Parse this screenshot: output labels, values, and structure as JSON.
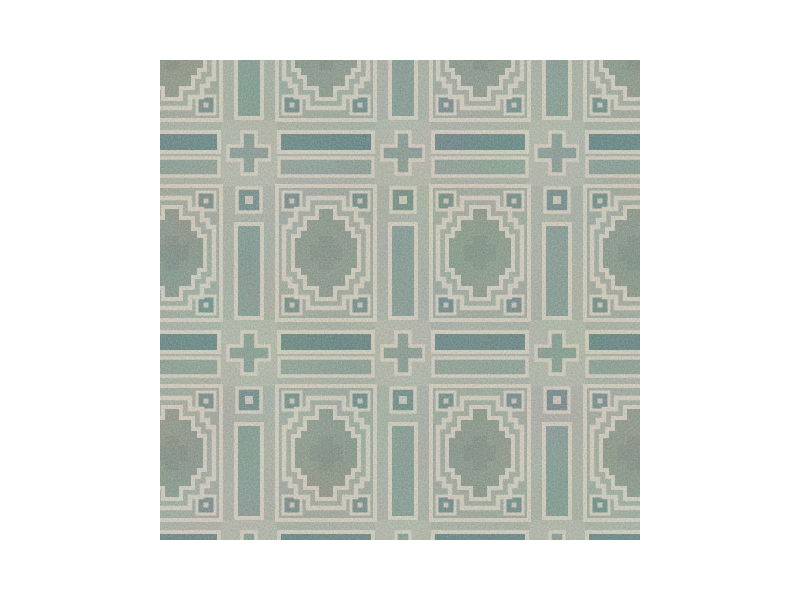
{
  "image": {
    "alt": "Close-up swatch photo of a hand-tufted wool area rug with a geometric Pueblo-style pattern: a grid of square tiles containing stepped-cross medallions, separated by channels of long bars, small knot squares and plus motifs, outlined in cream on a mottled sage-green, gray and teal ground, centered on a white background."
  },
  "palette": {
    "page-bg": "#ffffff",
    "cream": "#cdc7b7",
    "field": "#97a195",
    "field2": "#9aa396",
    "wash": "#d8d2c2",
    "medal": "#828f81",
    "medalcore": "#77837a",
    "barv": "#7c938a",
    "barh1": "#5e7d7c",
    "barh2": "#85988d",
    "knot": "#6a8480",
    "plus": "#7e948b"
  }
}
